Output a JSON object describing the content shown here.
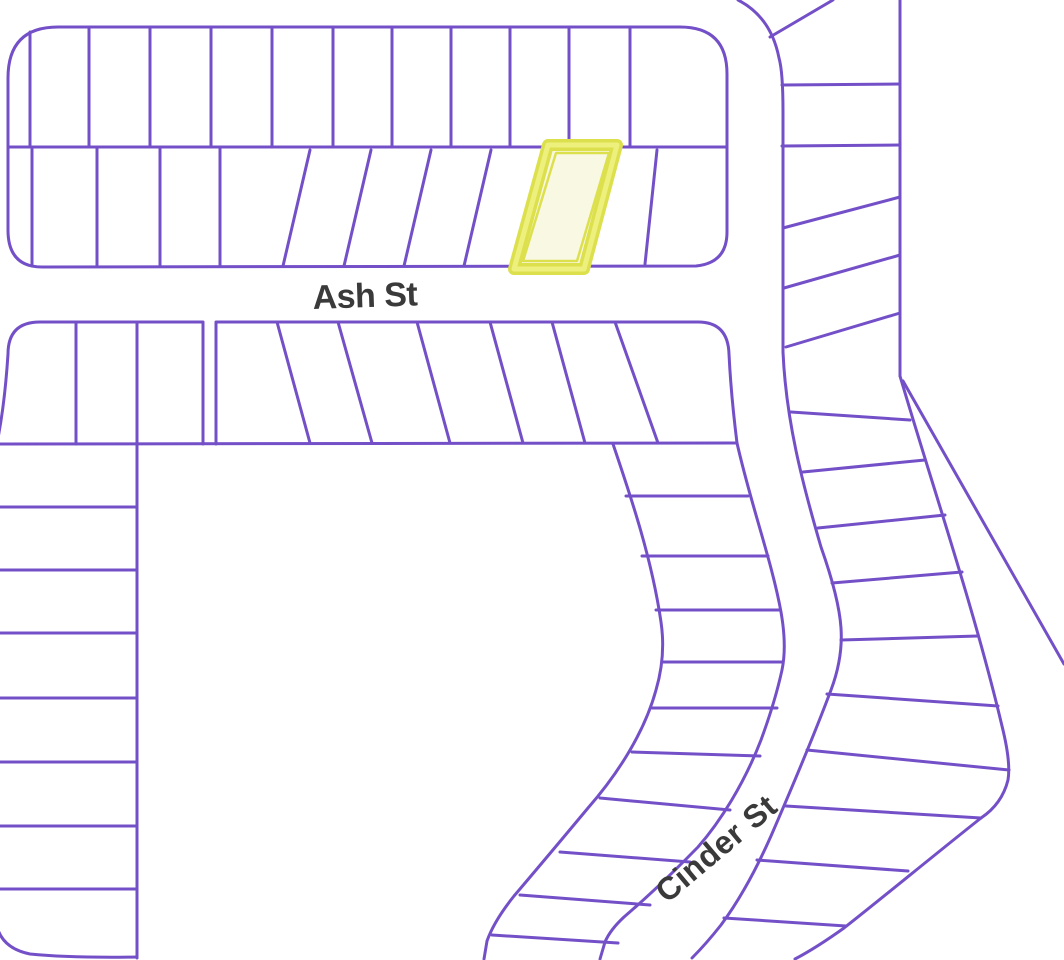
{
  "map": {
    "type": "plat-parcel-map",
    "streets": {
      "ash": {
        "label": "Ash St"
      },
      "cinder": {
        "label": "Cinder St"
      }
    },
    "highlight": {
      "description": "selected lot outlined in yellow, second row of north block"
    },
    "colors": {
      "background": "#ffffff",
      "line": "#7450c8",
      "label": "#3a3a3a",
      "highlight_fill": "#f8f8e3",
      "highlight_band": "#dde04d",
      "highlight_core": "#eef07d"
    }
  }
}
